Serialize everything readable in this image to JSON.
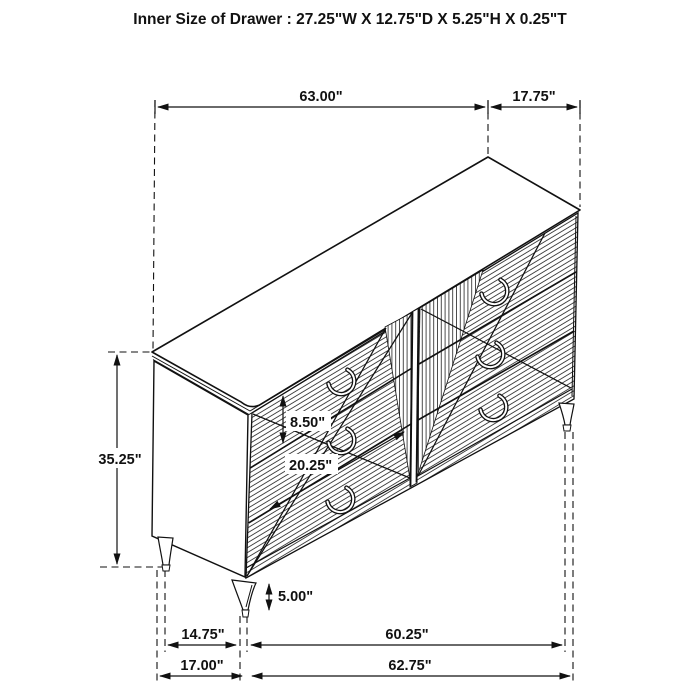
{
  "title": "Inner Size of Drawer : 27.25\"W X 12.75\"D X 5.25\"H X 0.25\"T",
  "dimensions": {
    "top_width": "63.00\"",
    "top_depth": "17.75\"",
    "overall_height": "35.25\"",
    "drawer_front_height": "8.50\"",
    "drawer_front_width": "20.25\"",
    "leg_height": "5.00\"",
    "leg_span_depth": "14.75\"",
    "leg_span_width": "60.25\"",
    "overall_depth": "17.00\"",
    "overall_width": "62.75\""
  },
  "colors": {
    "line": "#111111",
    "background": "#ffffff"
  }
}
